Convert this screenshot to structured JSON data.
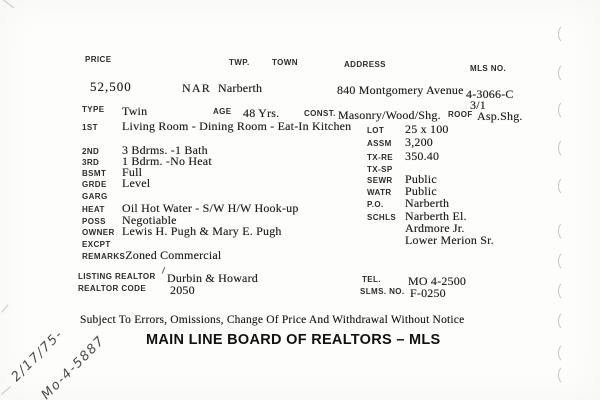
{
  "card": {
    "header": {
      "price_label": "PRICE",
      "price_value": "52,500",
      "twp_label": "TWP.",
      "twp_value": "NAR",
      "town_label": "TOWN",
      "town_value": "Narberth",
      "address_label": "ADDRESS",
      "address_value": "840 Montgomery Avenue",
      "mls_label": "MLS NO.",
      "mls_value": "4-3066-C",
      "mls_value2": "3/1"
    },
    "type_row": {
      "type_label": "TYPE",
      "type_value": "Twin",
      "age_label": "AGE",
      "age_value": "48 Yrs.",
      "const_label": "CONST.",
      "const_value": "Masonry/Wood/Shg.",
      "roof_label": "ROOF",
      "roof_value": "Asp.Shg."
    },
    "left_rows": [
      {
        "label": "1ST",
        "value": "Living Room - Dining Room - Eat-In Kitchen"
      },
      {
        "label": "2ND",
        "value": "3 Bdrms. -1 Bath"
      },
      {
        "label": "3RD",
        "value": "1 Bdrm. -No Heat"
      },
      {
        "label": "BSMT",
        "value": "Full"
      },
      {
        "label": "GRDE",
        "value": "Level"
      },
      {
        "label": "GARG",
        "value": ""
      },
      {
        "label": "HEAT",
        "value": "Oil Hot Water - S/W H/W Hook-up"
      },
      {
        "label": "POSS",
        "value": "Negotiable"
      },
      {
        "label": "OWNER",
        "value": "Lewis H. Pugh & Mary E. Pugh"
      },
      {
        "label": "EXCPT",
        "value": ""
      },
      {
        "label": "REMARKS",
        "value": "Zoned Commercial"
      }
    ],
    "right_rows": [
      {
        "label": "LOT",
        "value": "25 x 100"
      },
      {
        "label": "ASSM",
        "value": "3,200"
      },
      {
        "label": "TX-RE",
        "value": "350.40"
      },
      {
        "label": "TX-SP",
        "value": ""
      },
      {
        "label": "SEWR",
        "value": "Public"
      },
      {
        "label": "WATR",
        "value": "Public"
      },
      {
        "label": "P.O.",
        "value": "Narberth"
      },
      {
        "label": "SCHLS",
        "value": "Narberth El."
      },
      {
        "label": "",
        "value": "Ardmore Jr."
      },
      {
        "label": "",
        "value": "Lower Merion Sr."
      }
    ],
    "realtor": {
      "listing_realtor_label": "LISTING REALTOR",
      "listing_realtor_value": "Durbin & Howard",
      "realtor_code_label": "REALTOR CODE",
      "realtor_code_value": "2050",
      "tel_label": "TEL.",
      "tel_value": "MO 4-2500",
      "slms_label": "SLMS. NO.",
      "slms_value": "F-0250"
    },
    "footer": {
      "disclaimer": "Subject To Errors, Omissions, Change Of Price And Withdrawal Without Notice",
      "board_title": "MAIN LINE BOARD OF REALTORS – MLS"
    },
    "handwriting": {
      "date": "2/17/75-",
      "phone": "Mo-4-5887"
    }
  }
}
